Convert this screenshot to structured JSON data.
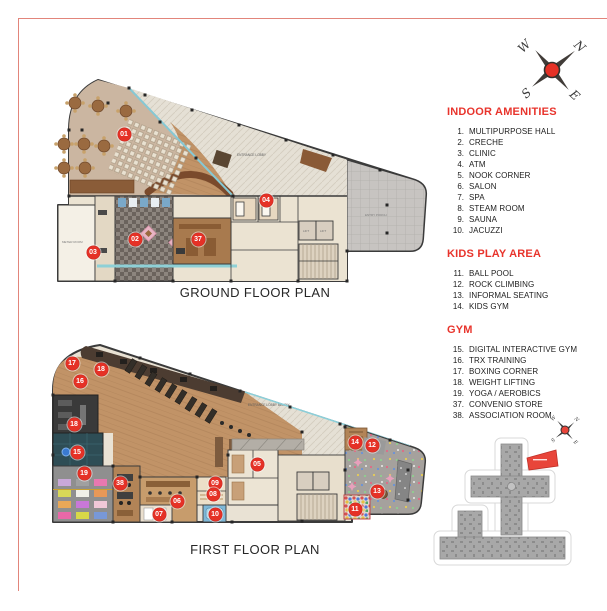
{
  "titles": {
    "ground": "GROUND FLOOR PLAN",
    "first": "FIRST FLOOR PLAN"
  },
  "legend": {
    "sections": [
      {
        "title": "INDOOR AMENITIES",
        "items": [
          {
            "num": "1.",
            "label": "MULTIPURPOSE HALL"
          },
          {
            "num": "2.",
            "label": "CRECHE"
          },
          {
            "num": "3.",
            "label": "CLINIC"
          },
          {
            "num": "4.",
            "label": "ATM"
          },
          {
            "num": "5.",
            "label": "NOOK CORNER"
          },
          {
            "num": "6.",
            "label": "SALON"
          },
          {
            "num": "7.",
            "label": "SPA"
          },
          {
            "num": "8.",
            "label": "STEAM ROOM"
          },
          {
            "num": "9.",
            "label": "SAUNA"
          },
          {
            "num": "10.",
            "label": "JACUZZI"
          }
        ]
      },
      {
        "title": "KIDS PLAY AREA",
        "items": [
          {
            "num": "11.",
            "label": "BALL POOL"
          },
          {
            "num": "12.",
            "label": "ROCK CLIMBING"
          },
          {
            "num": "13.",
            "label": "INFORMAL SEATING"
          },
          {
            "num": "14.",
            "label": "KIDS GYM"
          }
        ]
      },
      {
        "title": "GYM",
        "items": [
          {
            "num": "15.",
            "label": "DIGITAL INTERACTIVE GYM"
          },
          {
            "num": "16.",
            "label": "TRX TRAINING"
          },
          {
            "num": "17.",
            "label": "BOXING CORNER"
          },
          {
            "num": "18.",
            "label": "WEIGHT LIFTING"
          },
          {
            "num": "19.",
            "label": "YOGA / AEROBICS"
          },
          {
            "num": "37.",
            "label": "CONVENIO STORE"
          },
          {
            "num": "38.",
            "label": "ASSOCIATION ROOM"
          }
        ]
      }
    ]
  },
  "compass": {
    "n": "N",
    "e": "E",
    "s": "S",
    "w": "W"
  },
  "plans": {
    "ground": {
      "labels": {
        "entrance_lobby": "ENTRANCE LOBBY",
        "entry_porch": "ENTRY PORCH",
        "meter_room": "METER ROOM",
        "lift": "LIFT"
      },
      "markers": [
        "01",
        "02",
        "03",
        "04",
        "37"
      ]
    },
    "first": {
      "labels": {
        "entrance_lobby_below": "ENTRANCE LOBBY BELOW"
      },
      "markers": [
        "17",
        "18",
        "16",
        "18",
        "15",
        "19",
        "38",
        "06",
        "07",
        "09",
        "08",
        "10",
        "05",
        "14",
        "12",
        "13",
        "11"
      ]
    }
  },
  "colors": {
    "accent_red": "#e8342c",
    "marker_red": "#e53126",
    "wood": "#c19367",
    "hall_tan": "#cbb6a1",
    "teal_room": "#2e4d55"
  }
}
